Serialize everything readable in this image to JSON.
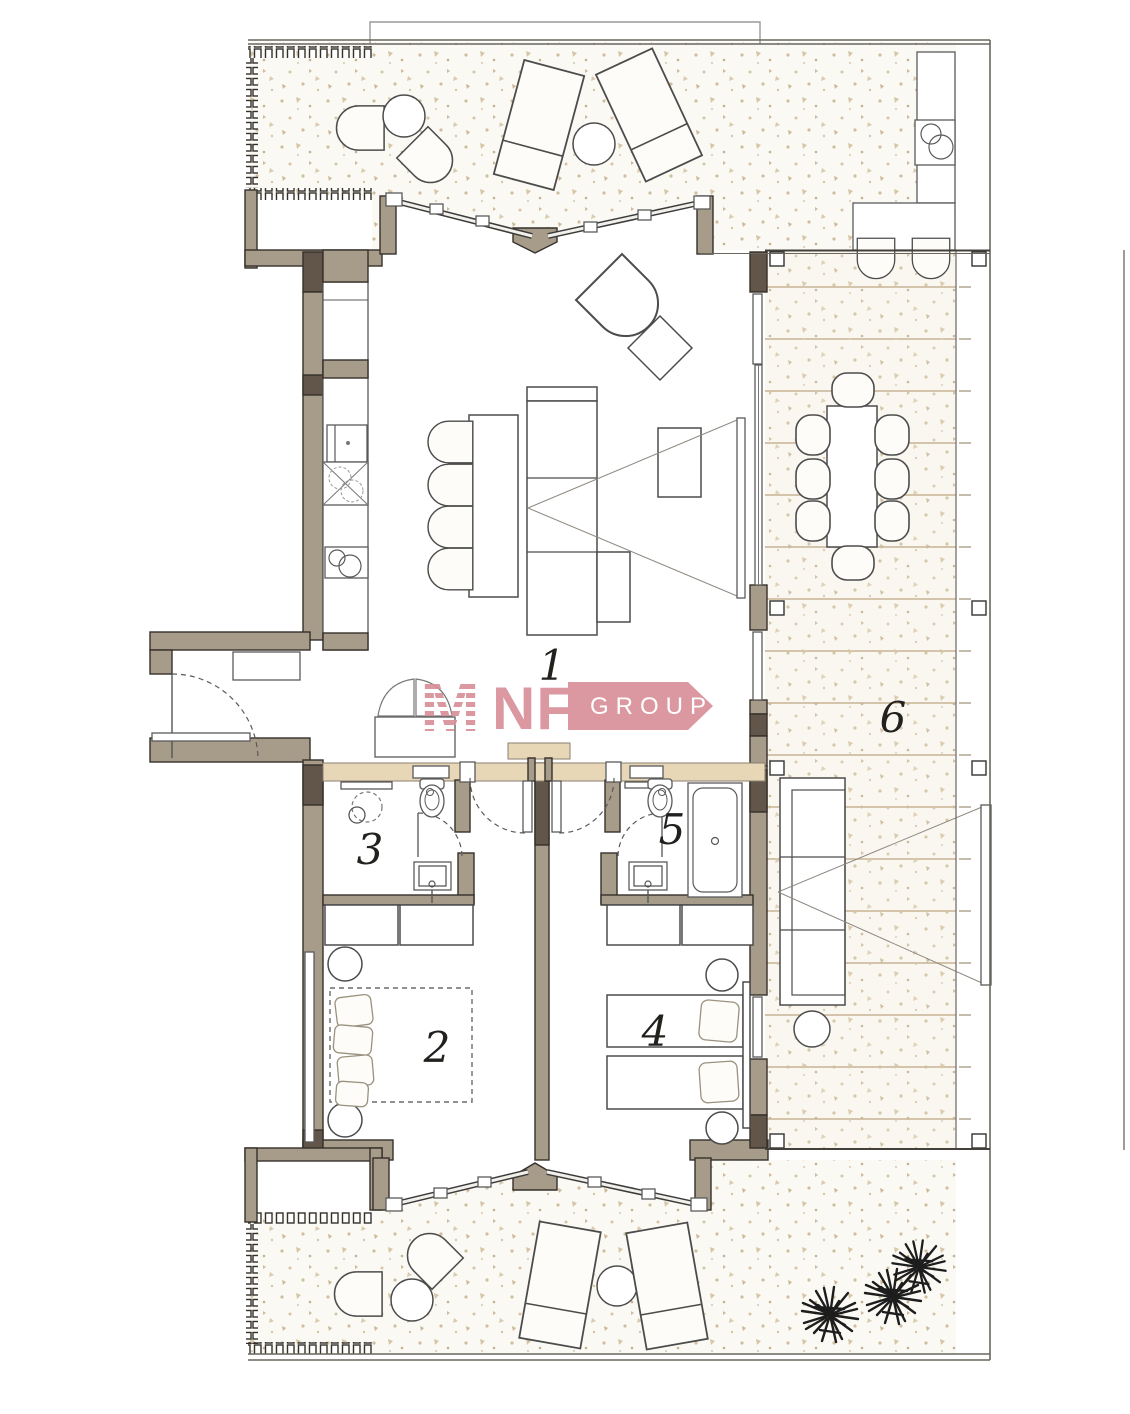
{
  "plan": {
    "title": "apartment-floor-plan",
    "rooms": [
      {
        "id": "living-kitchen",
        "label": "1"
      },
      {
        "id": "bedroom-left",
        "label": "2"
      },
      {
        "id": "bathroom-left",
        "label": "3"
      },
      {
        "id": "bedroom-right",
        "label": "4"
      },
      {
        "id": "bathroom-right",
        "label": "5"
      },
      {
        "id": "side-deck",
        "label": "6"
      }
    ],
    "logo": {
      "mark": "M",
      "name": "NF",
      "suffix": "GROUP"
    },
    "colors": {
      "wall": "#a79b89",
      "wall_dark": "#615649",
      "brand_pink": "#d9909a",
      "threshold_beige": "#e8d7b7",
      "stipple_beige": "#cfbf9e",
      "deck_plank": "#c8b394"
    }
  }
}
